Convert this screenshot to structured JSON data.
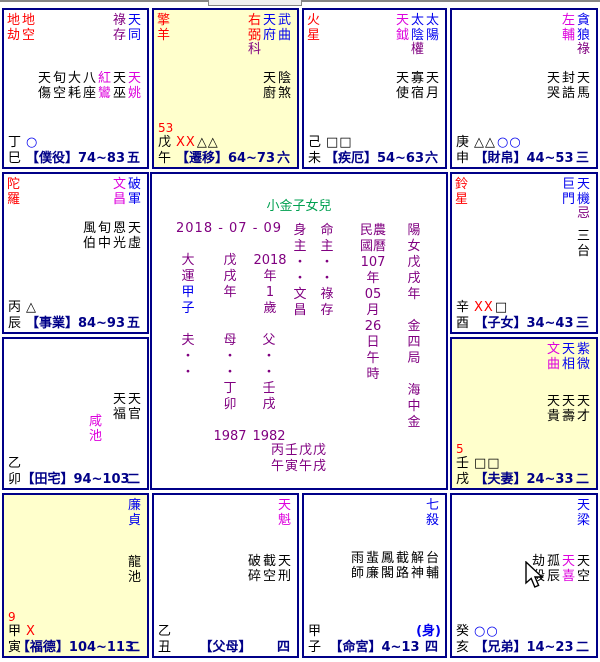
{
  "chart": {
    "colors": {
      "main_star": "#0000ee",
      "malefic_star": "#ff0000",
      "lucky_star": "#dd00dd",
      "hua_marker": "#800080",
      "palace_label": "#000088",
      "title_green": "#00a050",
      "highlight_bg": "#ffffcc",
      "border": "#000088"
    },
    "center": {
      "title": "小金子女兒",
      "date": "2018 - 07 - 09",
      "columns": [
        {
          "id": "dayun",
          "lines": [
            "大",
            "運",
            "甲",
            "子"
          ],
          "line_colors": [
            "purple",
            "purple",
            "blue",
            "blue"
          ]
        },
        {
          "id": "year-stem",
          "lines": [
            "戊",
            "戌",
            "年"
          ]
        },
        {
          "id": "year-age",
          "lines": [
            "2018",
            "年",
            "1",
            "歲"
          ]
        },
        {
          "id": "shenzhu",
          "lines": [
            "身",
            "主",
            "・",
            "・",
            "文",
            "昌"
          ]
        },
        {
          "id": "mingzhu",
          "lines": [
            "命",
            "主",
            "・",
            "・",
            "祿",
            "存"
          ]
        },
        {
          "id": "calendar",
          "lines": [
            "民農",
            "國曆",
            "107",
            "年",
            "05",
            "月",
            "26",
            "日",
            "午",
            "時"
          ]
        },
        {
          "id": "gender",
          "lines": [
            "陽",
            "女",
            "戊",
            "戌",
            "年",
            "",
            "金",
            "四",
            "局",
            "",
            "海",
            "中",
            "金"
          ]
        },
        {
          "id": "father-line",
          "lines": [
            "夫",
            "・",
            "・"
          ]
        },
        {
          "id": "mother-line",
          "lines": [
            "母",
            "・",
            "・",
            "丁",
            "卯",
            "",
            "1987"
          ]
        },
        {
          "id": "parent-line",
          "lines": [
            "父",
            "・",
            "・",
            "壬",
            "戌",
            "",
            "1982"
          ]
        }
      ],
      "pillars": [
        "丙壬戊戊",
        "午寅午戌"
      ]
    },
    "cells": [
      {
        "id": "si",
        "bg": "white",
        "stem": "丁",
        "branch": "巳",
        "label": "【僕役】",
        "range": "74~83",
        "corner": "五",
        "age": "",
        "body": "",
        "malefics": [
          "地劫",
          "地空"
        ],
        "mains": [
          {
            "n": "祿存",
            "c": "purple"
          },
          {
            "n": "天同",
            "c": "blue"
          }
        ],
        "minors": [
          {
            "n": "天傷",
            "c": "black"
          },
          {
            "n": "旬空",
            "c": "black"
          },
          {
            "n": "大耗",
            "c": "black"
          },
          {
            "n": "八座",
            "c": "black"
          },
          {
            "n": "紅鸞",
            "c": "magenta"
          },
          {
            "n": "天巫",
            "c": "black"
          },
          {
            "n": "天姚",
            "c": "magenta"
          }
        ],
        "symbols": [
          {
            "t": "○",
            "c": "blue"
          }
        ]
      },
      {
        "id": "wu",
        "bg": "yellow",
        "stem": "戊",
        "branch": "午",
        "label": "【遷移】",
        "range": "64~73",
        "corner": "六",
        "age": "53",
        "body": "",
        "malefics": [
          "擎羊"
        ],
        "mains": [
          {
            "n": "右弼",
            "c": "red",
            "hua": "科"
          },
          {
            "n": "天府",
            "c": "blue"
          },
          {
            "n": "武曲",
            "c": "blue"
          }
        ],
        "minors": [
          {
            "n": "天廚",
            "c": "black"
          },
          {
            "n": "陰煞",
            "c": "black"
          }
        ],
        "symbols": [
          {
            "t": "XX",
            "c": "red"
          },
          {
            "t": "△△",
            "c": "black"
          }
        ]
      },
      {
        "id": "wei",
        "bg": "white",
        "stem": "己",
        "branch": "未",
        "label": "【疾厄】",
        "range": "54~63",
        "corner": "六",
        "age": "",
        "body": "",
        "malefics": [
          "火星"
        ],
        "mains": [
          {
            "n": "天鉞",
            "c": "magenta"
          },
          {
            "n": "太陰",
            "c": "blue",
            "hua": "權"
          },
          {
            "n": "太陽",
            "c": "blue"
          }
        ],
        "minors": [
          {
            "n": "天使",
            "c": "black"
          },
          {
            "n": "寡宿",
            "c": "black"
          },
          {
            "n": "天月",
            "c": "black"
          }
        ],
        "symbols": [
          {
            "t": "□□",
            "c": "black"
          }
        ]
      },
      {
        "id": "shen",
        "bg": "white",
        "stem": "庚",
        "branch": "申",
        "label": "【財帛】",
        "range": "44~53",
        "corner": "三",
        "age": "",
        "body": "",
        "malefics": [],
        "mains": [
          {
            "n": "左輔",
            "c": "magenta"
          },
          {
            "n": "貪狼",
            "c": "blue",
            "hua": "祿"
          }
        ],
        "minors": [
          {
            "n": "天哭",
            "c": "black"
          },
          {
            "n": "封誥",
            "c": "black"
          },
          {
            "n": "天馬",
            "c": "black"
          }
        ],
        "symbols": [
          {
            "t": "△△",
            "c": "black"
          },
          {
            "t": "○○",
            "c": "blue"
          }
        ]
      },
      {
        "id": "chen",
        "bg": "white",
        "stem": "丙",
        "branch": "辰",
        "label": "【事業】",
        "range": "84~93",
        "corner": "五",
        "age": "",
        "body": "",
        "malefics": [
          "陀羅"
        ],
        "mains": [
          {
            "n": "文昌",
            "c": "magenta"
          },
          {
            "n": "破軍",
            "c": "blue"
          }
        ],
        "minors": [
          {
            "n": "風伯",
            "c": "black"
          },
          {
            "n": "旬中",
            "c": "black"
          },
          {
            "n": "恩光",
            "c": "black"
          },
          {
            "n": "天虛",
            "c": "black"
          }
        ],
        "symbols": [
          {
            "t": "△",
            "c": "black"
          }
        ]
      },
      {
        "id": "you",
        "bg": "white",
        "stem": "辛",
        "branch": "酉",
        "label": "【子女】",
        "range": "34~43",
        "corner": "三",
        "age": "",
        "body": "",
        "malefics": [
          "鈴星"
        ],
        "mains": [
          {
            "n": "巨門",
            "c": "blue"
          },
          {
            "n": "天機",
            "c": "blue",
            "hua": "忌"
          }
        ],
        "minors": [
          {
            "n": "三台",
            "c": "black"
          }
        ],
        "symbols": [
          {
            "t": "XX",
            "c": "red"
          },
          {
            "t": "□",
            "c": "black"
          }
        ]
      },
      {
        "id": "mao",
        "bg": "white",
        "stem": "乙",
        "branch": "卯",
        "label": "【田宅】",
        "range": "94~103",
        "corner": "二",
        "age": "",
        "body": "",
        "malefics": [],
        "mains": [],
        "minors": [
          {
            "n": "天福",
            "c": "black"
          },
          {
            "n": "天官",
            "c": "black"
          }
        ],
        "extra": {
          "n": "咸池",
          "c": "magenta"
        },
        "symbols": []
      },
      {
        "id": "xu",
        "bg": "yellow",
        "stem": "壬",
        "branch": "戌",
        "label": "【夫妻】",
        "range": "24~33",
        "corner": "二",
        "age": "5",
        "body": "",
        "malefics": [],
        "mains": [
          {
            "n": "文曲",
            "c": "magenta"
          },
          {
            "n": "天相",
            "c": "blue"
          },
          {
            "n": "紫微",
            "c": "blue"
          }
        ],
        "minors": [
          {
            "n": "天貴",
            "c": "black"
          },
          {
            "n": "天壽",
            "c": "black"
          },
          {
            "n": "天才",
            "c": "black"
          }
        ],
        "symbols": [
          {
            "t": "□□",
            "c": "black"
          }
        ]
      },
      {
        "id": "yin",
        "bg": "yellow",
        "stem": "甲",
        "branch": "寅",
        "label": "【福德】",
        "range": "104~113",
        "corner": "二",
        "age": "9",
        "body": "",
        "malefics": [],
        "mains": [
          {
            "n": "廉貞",
            "c": "blue"
          }
        ],
        "minors": [
          {
            "n": "龍池",
            "c": "black"
          }
        ],
        "symbols": [
          {
            "t": "X",
            "c": "red"
          }
        ]
      },
      {
        "id": "chou",
        "bg": "white",
        "stem": "乙",
        "branch": "丑",
        "label": "【父母】",
        "range": "",
        "corner": "四",
        "age": "",
        "body": "",
        "malefics": [],
        "mains": [
          {
            "n": "天魁",
            "c": "magenta"
          }
        ],
        "minors": [
          {
            "n": "破碎",
            "c": "black"
          },
          {
            "n": "截空",
            "c": "black"
          },
          {
            "n": "天刑",
            "c": "black"
          }
        ],
        "symbols": []
      },
      {
        "id": "zi",
        "bg": "white",
        "stem": "甲",
        "branch": "子",
        "label": "【命宮】",
        "range": "4~13",
        "corner": "四",
        "age": "",
        "body": "(身)",
        "malefics": [],
        "mains": [
          {
            "n": "七殺",
            "c": "blue"
          }
        ],
        "minors": [
          {
            "n": "雨師",
            "c": "black"
          },
          {
            "n": "蜚廉",
            "c": "black"
          },
          {
            "n": "鳳閣",
            "c": "black"
          },
          {
            "n": "截路",
            "c": "black"
          },
          {
            "n": "解神",
            "c": "black"
          },
          {
            "n": "台輔",
            "c": "black"
          }
        ],
        "symbols": []
      },
      {
        "id": "hai",
        "bg": "white",
        "stem": "癸",
        "branch": "亥",
        "label": "【兄弟】",
        "range": "14~23",
        "corner": "二",
        "age": "",
        "body": "",
        "malefics": [],
        "mains": [
          {
            "n": "天梁",
            "c": "blue"
          }
        ],
        "minors": [
          {
            "n": "劫殺",
            "c": "black"
          },
          {
            "n": "孤辰",
            "c": "black"
          },
          {
            "n": "天喜",
            "c": "magenta"
          },
          {
            "n": "天空",
            "c": "black"
          }
        ],
        "symbols": [
          {
            "t": "○○",
            "c": "blue"
          }
        ]
      }
    ]
  }
}
